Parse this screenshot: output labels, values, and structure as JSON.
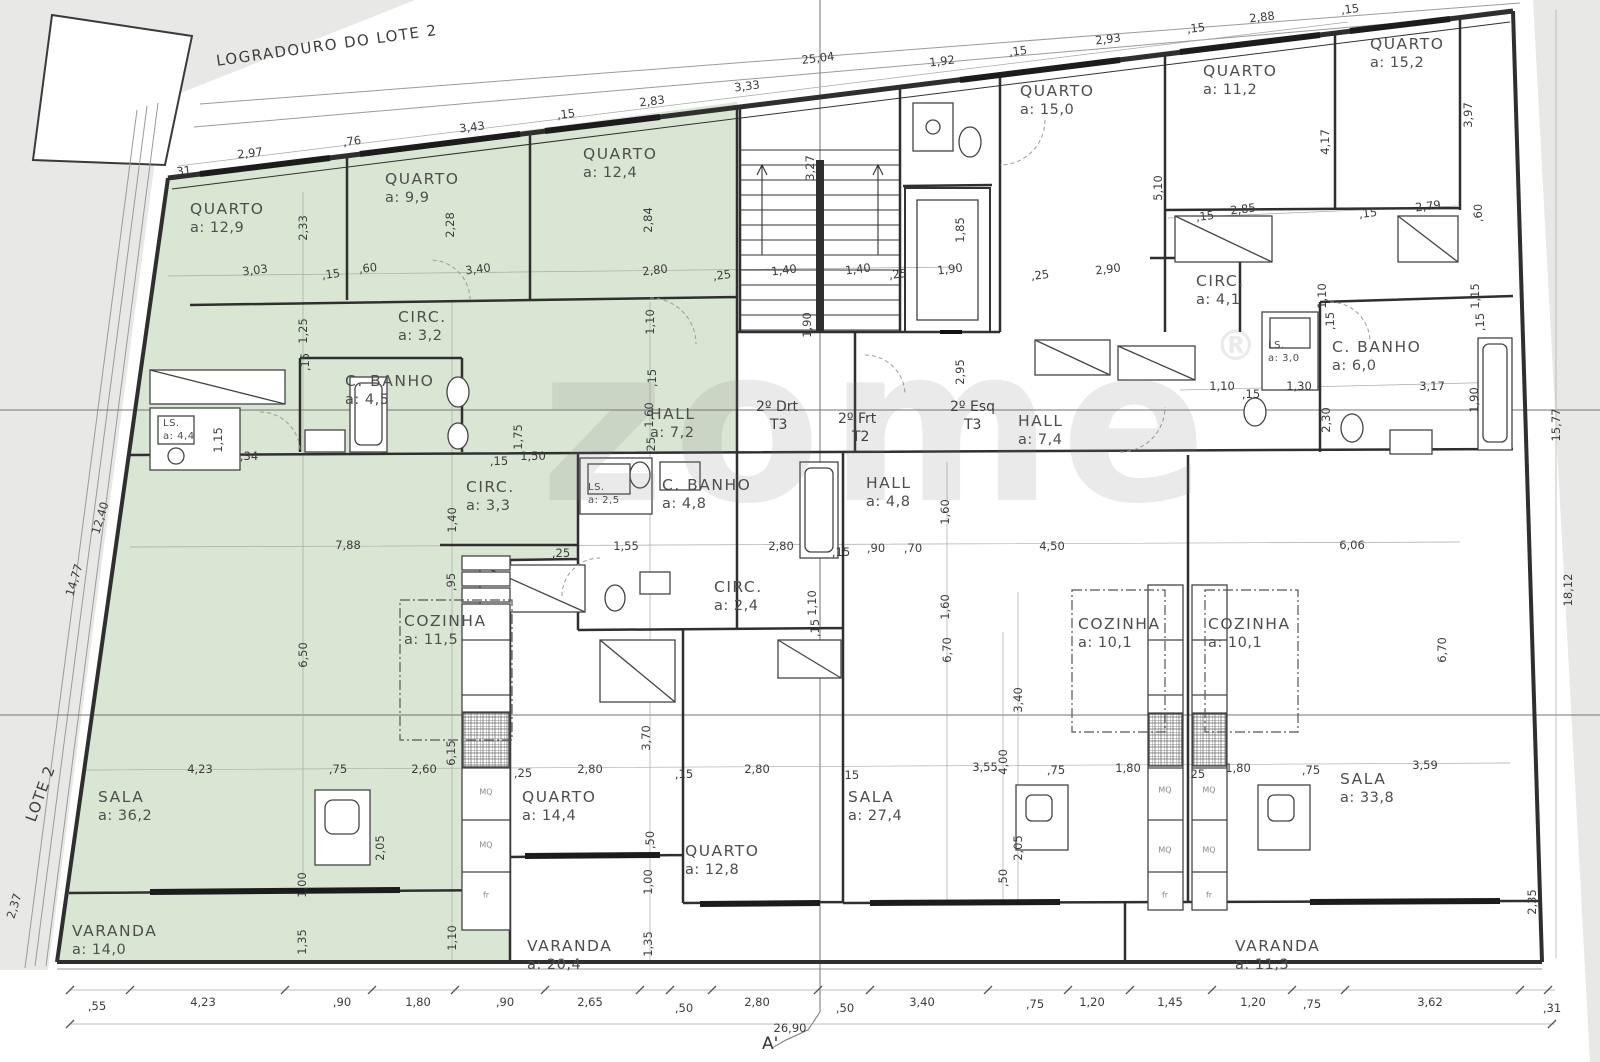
{
  "meta": {
    "logradouro": "LOGRADOURO DO LOTE 2",
    "lote": "LOTE 2",
    "section_marker": "A'",
    "watermark": "zome",
    "registered": "®",
    "highlight_color": "#d9e6d3",
    "background_gray": "#e8e8e6",
    "wall_color": "#2f2f2f"
  },
  "units": [
    {
      "label": "2º Drt",
      "type": "T3",
      "x": 756,
      "y": 398
    },
    {
      "label": "2º Frt",
      "type": "T2",
      "x": 838,
      "y": 410
    },
    {
      "label": "2º Esq",
      "type": "T3",
      "x": 950,
      "y": 398
    }
  ],
  "rooms": [
    {
      "name": "QUARTO",
      "area": "a: 12,9",
      "x": 190,
      "y": 200
    },
    {
      "name": "QUARTO",
      "area": "a: 9,9",
      "x": 385,
      "y": 170
    },
    {
      "name": "QUARTO",
      "area": "a: 12,4",
      "x": 583,
      "y": 145
    },
    {
      "name": "CIRC.",
      "area": "a: 3,2",
      "x": 398,
      "y": 308
    },
    {
      "name": "C. BANHO",
      "area": "a: 4,5",
      "x": 345,
      "y": 372
    },
    {
      "name": "LS.",
      "area": "a: 4,4",
      "x": 163,
      "y": 418,
      "small": true
    },
    {
      "name": "CIRC.",
      "area": "a: 3,3",
      "x": 466,
      "y": 478
    },
    {
      "name": "HALL",
      "area": "a: 7,2",
      "x": 650,
      "y": 405
    },
    {
      "name": "COZINHA",
      "area": "a: 11,5",
      "x": 404,
      "y": 612
    },
    {
      "name": "SALA",
      "area": "a: 36,2",
      "x": 98,
      "y": 788
    },
    {
      "name": "VARANDA",
      "area": "a: 14,0",
      "x": 72,
      "y": 922
    },
    {
      "name": "QUARTO",
      "area": "a: 15,0",
      "x": 1020,
      "y": 82
    },
    {
      "name": "QUARTO",
      "area": "a: 11,2",
      "x": 1203,
      "y": 62
    },
    {
      "name": "QUARTO",
      "area": "a: 15,2",
      "x": 1370,
      "y": 35
    },
    {
      "name": "CIRC.",
      "area": "a: 4,1",
      "x": 1196,
      "y": 272
    },
    {
      "name": "LS.",
      "area": "a: 3,0",
      "x": 1268,
      "y": 340,
      "small": true
    },
    {
      "name": "C. BANHO",
      "area": "a: 6,0",
      "x": 1332,
      "y": 338
    },
    {
      "name": "HALL",
      "area": "a: 7,4",
      "x": 1018,
      "y": 412
    },
    {
      "name": "HALL",
      "area": "a: 4,8",
      "x": 866,
      "y": 474
    },
    {
      "name": "C. BANHO",
      "area": "a: 4,8",
      "x": 662,
      "y": 476
    },
    {
      "name": "LS.",
      "area": "a: 2,5",
      "x": 588,
      "y": 482,
      "small": true
    },
    {
      "name": "CIRC.",
      "area": "a: 2,4",
      "x": 714,
      "y": 578
    },
    {
      "name": "COZINHA",
      "area": "a: 10,1",
      "x": 1078,
      "y": 615
    },
    {
      "name": "COZINHA",
      "area": "a: 10,1",
      "x": 1208,
      "y": 615
    },
    {
      "name": "QUARTO",
      "area": "a: 14,4",
      "x": 522,
      "y": 788
    },
    {
      "name": "QUARTO",
      "area": "a: 12,8",
      "x": 685,
      "y": 842
    },
    {
      "name": "SALA",
      "area": "a: 27,4",
      "x": 848,
      "y": 788
    },
    {
      "name": "SALA",
      "area": "a: 33,8",
      "x": 1340,
      "y": 770
    },
    {
      "name": "VARANDA",
      "area": "a: 20,4",
      "x": 527,
      "y": 937
    },
    {
      "name": "VARANDA",
      "area": "a: 11,3",
      "x": 1235,
      "y": 937
    }
  ],
  "dims": [
    {
      "t": ",31",
      "x": 182,
      "y": 171,
      "c": "s"
    },
    {
      "t": "2,97",
      "x": 250,
      "y": 153,
      "c": "s"
    },
    {
      "t": ",76",
      "x": 352,
      "y": 141,
      "c": "s"
    },
    {
      "t": "3,43",
      "x": 472,
      "y": 127,
      "c": "s"
    },
    {
      "t": ",15",
      "x": 566,
      "y": 114,
      "c": "s"
    },
    {
      "t": "2,83",
      "x": 652,
      "y": 101,
      "c": "s"
    },
    {
      "t": "3,33",
      "x": 747,
      "y": 86,
      "c": "s"
    },
    {
      "t": "25,04",
      "x": 818,
      "y": 58,
      "c": "s"
    },
    {
      "t": "1,92",
      "x": 942,
      "y": 61,
      "c": "s"
    },
    {
      "t": ",15",
      "x": 1018,
      "y": 51,
      "c": "s"
    },
    {
      "t": "2,93",
      "x": 1108,
      "y": 39,
      "c": "s"
    },
    {
      "t": ",15",
      "x": 1196,
      "y": 28,
      "c": "s"
    },
    {
      "t": "2,88",
      "x": 1262,
      "y": 17,
      "c": "s"
    },
    {
      "t": ",15",
      "x": 1350,
      "y": 9,
      "c": "s"
    },
    {
      "t": "3,03",
      "x": 255,
      "y": 270,
      "c": "s"
    },
    {
      "t": ",15",
      "x": 331,
      "y": 274,
      "c": "s"
    },
    {
      "t": ",60",
      "x": 368,
      "y": 268,
      "c": "s"
    },
    {
      "t": "3,40",
      "x": 478,
      "y": 269,
      "c": "s"
    },
    {
      "t": "2,80",
      "x": 655,
      "y": 270,
      "c": "s"
    },
    {
      "t": ",25",
      "x": 722,
      "y": 275,
      "c": "s"
    },
    {
      "t": "1,40",
      "x": 784,
      "y": 270,
      "c": "s"
    },
    {
      "t": "1,40",
      "x": 858,
      "y": 269,
      "c": "s"
    },
    {
      "t": ",25",
      "x": 898,
      "y": 274,
      "c": "s"
    },
    {
      "t": "1,90",
      "x": 950,
      "y": 269,
      "c": "s"
    },
    {
      "t": ",25",
      "x": 1040,
      "y": 275,
      "c": "s"
    },
    {
      "t": "2,90",
      "x": 1108,
      "y": 269,
      "c": "s"
    },
    {
      "t": ",15",
      "x": 1205,
      "y": 216,
      "c": "s"
    },
    {
      "t": "2,85",
      "x": 1243,
      "y": 209,
      "c": "s"
    },
    {
      "t": ",15",
      "x": 1368,
      "y": 213,
      "c": "s"
    },
    {
      "t": "2,79",
      "x": 1428,
      "y": 206,
      "c": "s"
    },
    {
      "t": "1,10",
      "x": 1222,
      "y": 386,
      "c": "h"
    },
    {
      "t": ",15",
      "x": 1251,
      "y": 394,
      "c": "h"
    },
    {
      "t": "1,30",
      "x": 1299,
      "y": 386,
      "c": "h"
    },
    {
      "t": "3,17",
      "x": 1432,
      "y": 386,
      "c": "h"
    },
    {
      "t": ",15",
      "x": 499,
      "y": 461,
      "c": "h"
    },
    {
      "t": "1,50",
      "x": 533,
      "y": 456,
      "c": "h"
    },
    {
      "t": ",34",
      "x": 249,
      "y": 456,
      "c": "h"
    },
    {
      "t": "7,88",
      "x": 348,
      "y": 545,
      "c": "h"
    },
    {
      "t": ",25",
      "x": 561,
      "y": 553,
      "c": "h"
    },
    {
      "t": "1,55",
      "x": 626,
      "y": 546,
      "c": "h"
    },
    {
      "t": "2,80",
      "x": 781,
      "y": 546,
      "c": "h"
    },
    {
      "t": ",15",
      "x": 841,
      "y": 552,
      "c": "h"
    },
    {
      "t": ",90",
      "x": 876,
      "y": 548,
      "c": "h"
    },
    {
      "t": ",70",
      "x": 913,
      "y": 548,
      "c": "h"
    },
    {
      "t": "4,50",
      "x": 1052,
      "y": 546,
      "c": "h"
    },
    {
      "t": "6,06",
      "x": 1352,
      "y": 545,
      "c": "h"
    },
    {
      "t": "4,23",
      "x": 200,
      "y": 769,
      "c": "h"
    },
    {
      "t": ",75",
      "x": 338,
      "y": 769,
      "c": "h"
    },
    {
      "t": "2,60",
      "x": 424,
      "y": 769,
      "c": "h"
    },
    {
      "t": ",25",
      "x": 523,
      "y": 773,
      "c": "h"
    },
    {
      "t": "2,80",
      "x": 590,
      "y": 769,
      "c": "h"
    },
    {
      "t": ",15",
      "x": 684,
      "y": 774,
      "c": "h"
    },
    {
      "t": "2,80",
      "x": 757,
      "y": 769,
      "c": "h"
    },
    {
      "t": ",15",
      "x": 850,
      "y": 775,
      "c": "h"
    },
    {
      "t": "3,55",
      "x": 985,
      "y": 767,
      "c": "h"
    },
    {
      "t": ",75",
      "x": 1056,
      "y": 770,
      "c": "h"
    },
    {
      "t": "1,80",
      "x": 1128,
      "y": 768,
      "c": "h"
    },
    {
      "t": ",25",
      "x": 1196,
      "y": 774,
      "c": "h"
    },
    {
      "t": "1,80",
      "x": 1238,
      "y": 768,
      "c": "h"
    },
    {
      "t": ",75",
      "x": 1311,
      "y": 770,
      "c": "h"
    },
    {
      "t": "3,59",
      "x": 1425,
      "y": 765,
      "c": "h"
    },
    {
      "t": ",55",
      "x": 97,
      "y": 1006,
      "c": "h"
    },
    {
      "t": "4,23",
      "x": 203,
      "y": 1002,
      "c": "h"
    },
    {
      "t": ",90",
      "x": 342,
      "y": 1002,
      "c": "h"
    },
    {
      "t": "1,80",
      "x": 418,
      "y": 1002,
      "c": "h"
    },
    {
      "t": ",90",
      "x": 505,
      "y": 1002,
      "c": "h"
    },
    {
      "t": "2,65",
      "x": 590,
      "y": 1002,
      "c": "h"
    },
    {
      "t": ",50",
      "x": 684,
      "y": 1008,
      "c": "h"
    },
    {
      "t": "2,80",
      "x": 757,
      "y": 1002,
      "c": "h"
    },
    {
      "t": ",50",
      "x": 845,
      "y": 1008,
      "c": "h"
    },
    {
      "t": "3,40",
      "x": 922,
      "y": 1002,
      "c": "h"
    },
    {
      "t": ",75",
      "x": 1035,
      "y": 1004,
      "c": "h"
    },
    {
      "t": "1,20",
      "x": 1092,
      "y": 1002,
      "c": "h"
    },
    {
      "t": "1,45",
      "x": 1170,
      "y": 1002,
      "c": "h"
    },
    {
      "t": "1,20",
      "x": 1253,
      "y": 1002,
      "c": "h"
    },
    {
      "t": ",75",
      "x": 1312,
      "y": 1004,
      "c": "h"
    },
    {
      "t": "3,62",
      "x": 1430,
      "y": 1002,
      "c": "h"
    },
    {
      "t": ",31",
      "x": 1552,
      "y": 1008,
      "c": "h"
    },
    {
      "t": "26,90",
      "x": 790,
      "y": 1028,
      "c": "h"
    },
    {
      "t": "2,33",
      "x": 303,
      "y": 228,
      "c": "v"
    },
    {
      "t": "2,28",
      "x": 450,
      "y": 225,
      "c": "v"
    },
    {
      "t": "2,84",
      "x": 648,
      "y": 220,
      "c": "v"
    },
    {
      "t": "3,27",
      "x": 810,
      "y": 168,
      "c": "v"
    },
    {
      "t": "1,85",
      "x": 960,
      "y": 230,
      "c": "v"
    },
    {
      "t": "1,90",
      "x": 807,
      "y": 325,
      "c": "v"
    },
    {
      "t": "5,10",
      "x": 1158,
      "y": 188,
      "c": "v"
    },
    {
      "t": "4,17",
      "x": 1325,
      "y": 142,
      "c": "v"
    },
    {
      "t": "3,97",
      "x": 1468,
      "y": 115,
      "c": "v"
    },
    {
      "t": ",60",
      "x": 1478,
      "y": 213,
      "c": "v"
    },
    {
      "t": "1,10",
      "x": 650,
      "y": 322,
      "c": "v"
    },
    {
      "t": ",15",
      "x": 652,
      "y": 378,
      "c": "v"
    },
    {
      "t": "1,60",
      "x": 649,
      "y": 415,
      "c": "v"
    },
    {
      "t": ",25",
      "x": 651,
      "y": 446,
      "c": "v"
    },
    {
      "t": "2,95",
      "x": 960,
      "y": 372,
      "c": "v"
    },
    {
      "t": "1,10",
      "x": 1322,
      "y": 296,
      "c": "v"
    },
    {
      "t": ",15",
      "x": 1330,
      "y": 321,
      "c": "v"
    },
    {
      "t": "1,15",
      "x": 1475,
      "y": 296,
      "c": "v"
    },
    {
      "t": ",15",
      "x": 1480,
      "y": 322,
      "c": "v"
    },
    {
      "t": "2,30",
      "x": 1326,
      "y": 420,
      "c": "v"
    },
    {
      "t": "1,90",
      "x": 1474,
      "y": 400,
      "c": "v"
    },
    {
      "t": "1,25",
      "x": 303,
      "y": 331,
      "c": "v"
    },
    {
      "t": ",15",
      "x": 305,
      "y": 362,
      "c": "v"
    },
    {
      "t": "1,15",
      "x": 218,
      "y": 440,
      "c": "v"
    },
    {
      "t": "1,75",
      "x": 518,
      "y": 437,
      "c": "v"
    },
    {
      "t": "1,40",
      "x": 452,
      "y": 520,
      "c": "v"
    },
    {
      "t": ",95",
      "x": 451,
      "y": 582,
      "c": "v"
    },
    {
      "t": "6,50",
      "x": 303,
      "y": 655,
      "c": "v"
    },
    {
      "t": "6,15",
      "x": 451,
      "y": 753,
      "c": "v"
    },
    {
      "t": "2,05",
      "x": 380,
      "y": 848,
      "c": "v"
    },
    {
      "t": "2,05",
      "x": 1018,
      "y": 848,
      "c": "v"
    },
    {
      "t": "1,00",
      "x": 302,
      "y": 885,
      "c": "v"
    },
    {
      "t": "1,35",
      "x": 302,
      "y": 942,
      "c": "v"
    },
    {
      "t": "1,00",
      "x": 648,
      "y": 882,
      "c": "v"
    },
    {
      "t": "1,35",
      "x": 648,
      "y": 944,
      "c": "v"
    },
    {
      "t": "3,70",
      "x": 646,
      "y": 738,
      "c": "v"
    },
    {
      "t": "4,00",
      "x": 1003,
      "y": 762,
      "c": "v"
    },
    {
      "t": ",50",
      "x": 1003,
      "y": 878,
      "c": "v"
    },
    {
      "t": ",50",
      "x": 650,
      "y": 840,
      "c": "v"
    },
    {
      "t": "3,40",
      "x": 1018,
      "y": 700,
      "c": "v"
    },
    {
      "t": "6,70",
      "x": 947,
      "y": 650,
      "c": "v"
    },
    {
      "t": "6,70",
      "x": 1442,
      "y": 650,
      "c": "v"
    },
    {
      "t": "1,60",
      "x": 945,
      "y": 512,
      "c": "v"
    },
    {
      "t": "1,60",
      "x": 945,
      "y": 607,
      "c": "v"
    },
    {
      "t": "1,10",
      "x": 812,
      "y": 603,
      "c": "v"
    },
    {
      "t": ",15",
      "x": 815,
      "y": 628,
      "c": "v"
    },
    {
      "t": "1,10",
      "x": 452,
      "y": 938,
      "c": "v"
    },
    {
      "t": "15,77",
      "x": 1556,
      "y": 425,
      "c": "v"
    },
    {
      "t": "18,12",
      "x": 1568,
      "y": 590,
      "c": "v"
    },
    {
      "t": "2,35",
      "x": 1532,
      "y": 902,
      "c": "v"
    },
    {
      "t": "2,37",
      "x": 14,
      "y": 906,
      "c": "p"
    },
    {
      "t": "12,40",
      "x": 100,
      "y": 518,
      "c": "p"
    },
    {
      "t": "14,77",
      "x": 74,
      "y": 580,
      "c": "p"
    },
    {
      "t": "MQ",
      "x": 486,
      "y": 792,
      "c": "t"
    },
    {
      "t": "MQ",
      "x": 486,
      "y": 845,
      "c": "t"
    },
    {
      "t": "fr",
      "x": 486,
      "y": 895,
      "c": "t"
    },
    {
      "t": "MQ",
      "x": 1165,
      "y": 790,
      "c": "t"
    },
    {
      "t": "MQ",
      "x": 1209,
      "y": 790,
      "c": "t"
    },
    {
      "t": "MQ",
      "x": 1165,
      "y": 850,
      "c": "t"
    },
    {
      "t": "MQ",
      "x": 1209,
      "y": 850,
      "c": "t"
    },
    {
      "t": "fr",
      "x": 1165,
      "y": 895,
      "c": "t"
    },
    {
      "t": "fr",
      "x": 1209,
      "y": 895,
      "c": "t"
    }
  ]
}
